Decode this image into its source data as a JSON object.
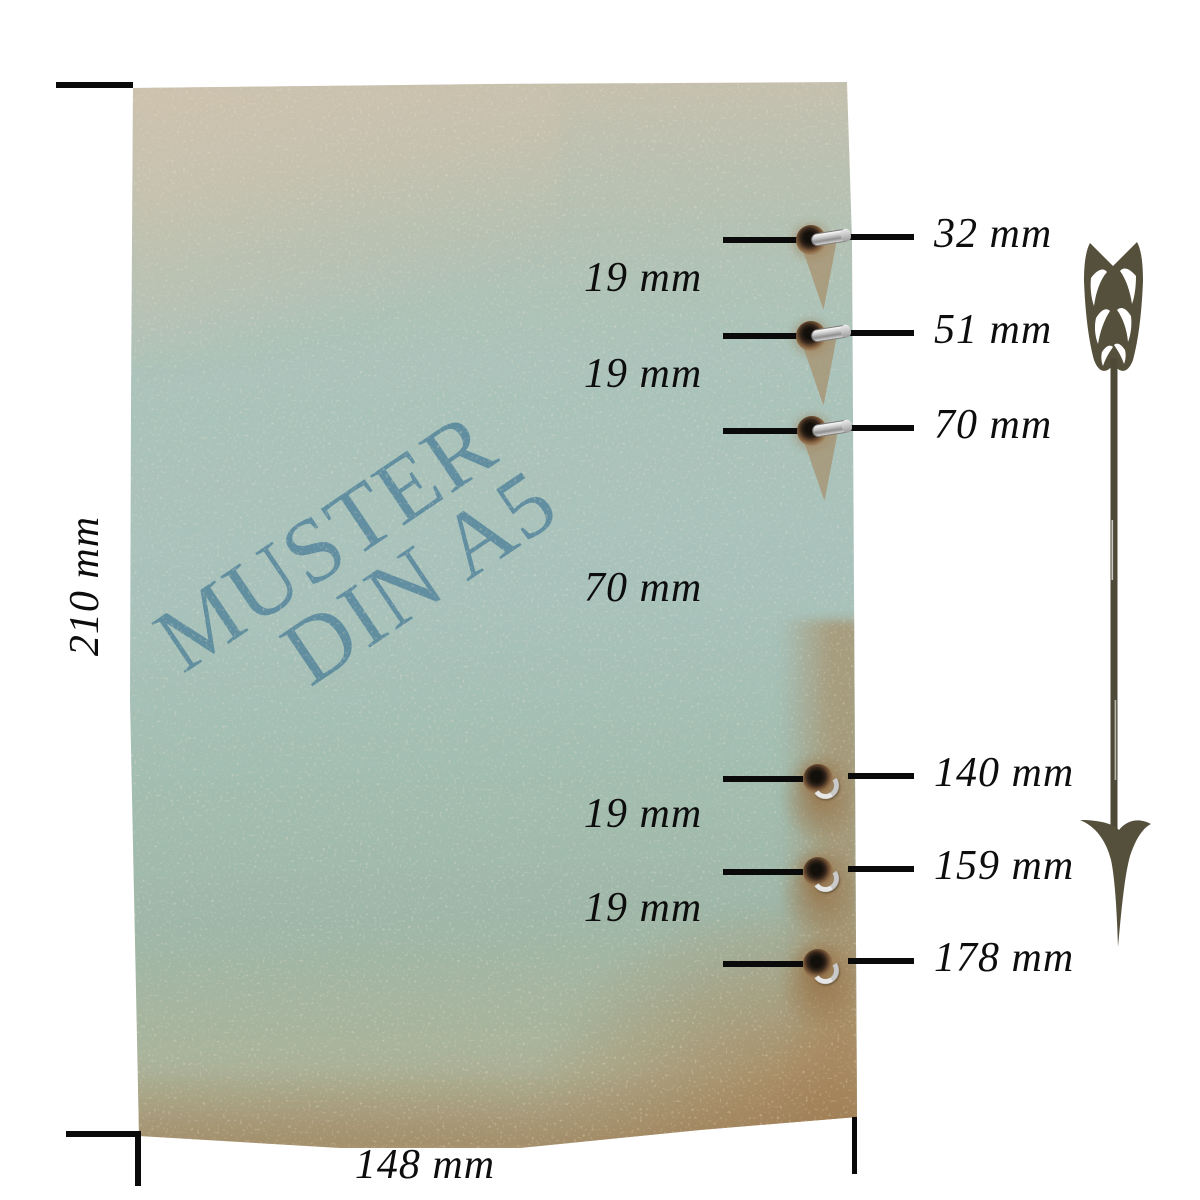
{
  "title": "DIN A5 cover hole-spacing diagram",
  "paper": {
    "watermark": {
      "line1": "MUSTER",
      "line2": "DIN A5",
      "color": "#5c8b9e"
    }
  },
  "dimensions": {
    "height": {
      "label": "210 mm"
    },
    "width": {
      "label": "148 mm"
    }
  },
  "holes": [
    {
      "label": "32 mm",
      "y": 240,
      "eyelet_x": 811,
      "fastener": "pin"
    },
    {
      "label": "51 mm",
      "y": 336,
      "eyelet_x": 811,
      "fastener": "pin"
    },
    {
      "label": "70 mm",
      "y": 431,
      "eyelet_x": 812,
      "fastener": "pin"
    },
    {
      "label": "140 mm",
      "y": 779,
      "eyelet_x": 818,
      "fastener": "ring"
    },
    {
      "label": "159 mm",
      "y": 872,
      "eyelet_x": 818,
      "fastener": "ring"
    },
    {
      "label": "178 mm",
      "y": 964,
      "eyelet_x": 818,
      "fastener": "ring"
    }
  ],
  "gaps": [
    {
      "label": "19 mm",
      "y": 283
    },
    {
      "label": "19 mm",
      "y": 379
    },
    {
      "label": "70 mm",
      "y": 593
    },
    {
      "label": "19 mm",
      "y": 819
    },
    {
      "label": "19 mm",
      "y": 913
    }
  ],
  "arrow": {
    "color": "#55503b"
  },
  "colors": {
    "paper_teal": "#a9c3bb",
    "paper_beige": "#ccc1ae",
    "paper_brown": "#ab9166",
    "line": "#0a0a0a"
  }
}
